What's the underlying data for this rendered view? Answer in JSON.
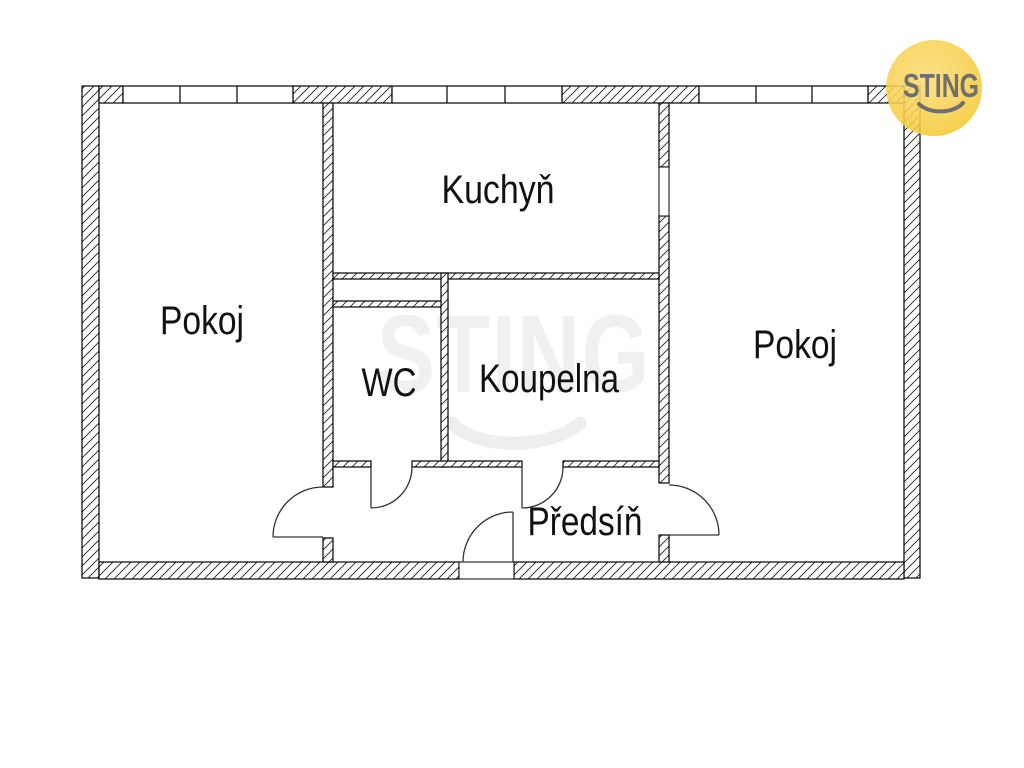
{
  "document": {
    "type": "apartment-floor-plan"
  },
  "branding": {
    "logo_text": "STING",
    "watermark_text": "STING",
    "logo_circle_edge_color": "#F5C832",
    "logo_circle_center_color": "#F9DD76",
    "logo_text_color": "#6F6F6F"
  },
  "colors": {
    "background": "#FFFFFF",
    "wall_line": "#000000",
    "hatch_line": "#222222",
    "label_text": "#111111",
    "watermark": "#F0F0F0"
  },
  "rooms": [
    {
      "id": "room-left",
      "label": "Pokoj"
    },
    {
      "id": "kitchen",
      "label": "Kuchyň"
    },
    {
      "id": "wc",
      "label": "WC"
    },
    {
      "id": "bathroom",
      "label": "Koupelna"
    },
    {
      "id": "room-right",
      "label": "Pokoj"
    },
    {
      "id": "hallway",
      "label": "Předsíň"
    }
  ]
}
